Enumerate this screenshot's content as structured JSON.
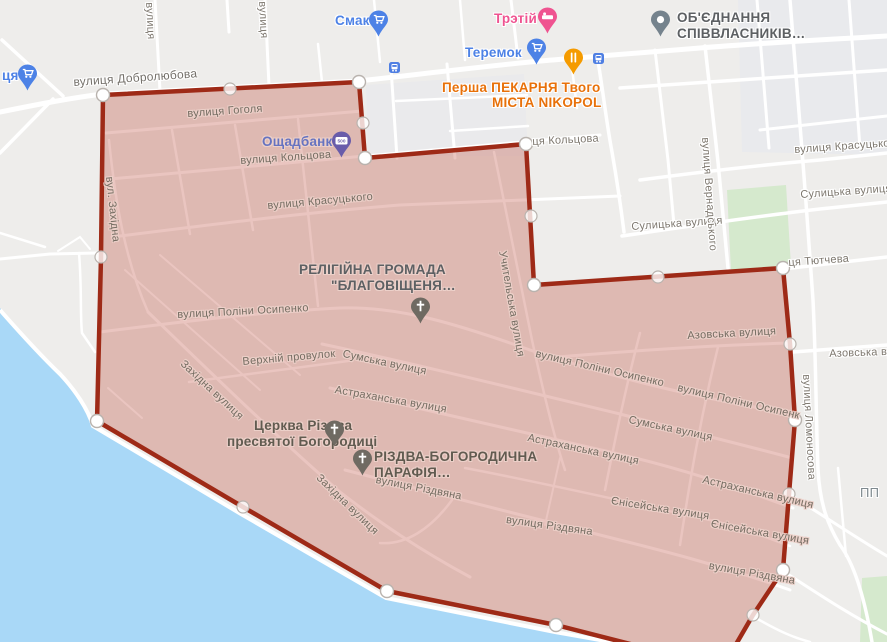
{
  "map_meta": {
    "description": "Map of Nikopol, Ukraine with red polygon area selection",
    "colors": {
      "land": "#eeedeb",
      "blocks_cool": "#e9eaed",
      "road": "#ffffff",
      "water": "#a9d8f7",
      "park": "#d5e9cd",
      "polygon_fill": "#be4b3c",
      "polygon_fill_opacity": "0.32",
      "polygon_stroke": "#9e2a17",
      "vertex_fill": "#ffffff",
      "poi_blue": "#4d82e6",
      "poi_pink": "#ef5390",
      "poi_orange": "#e8710a",
      "poi_violet": "#6673c0",
      "bank_pin": "#695caa",
      "gray_pin": "#75838d",
      "church_pin": "#6f6a62",
      "street_label": "#7d776e"
    }
  },
  "streets": {
    "dobrolyubova": "вулиця Добролюбова",
    "vulytsya": "вулиця",
    "gogolya": "вулиця Гоголя",
    "koltsova": "вулиця Кольцова",
    "tsya_koltsova": "ця Кольцова",
    "krasutskogo": "вулиця Красуцького",
    "zahidna_short": "вул. Західна",
    "polina_osypenko": "вулиця Поліни Осипенко",
    "polina_osypenko_cut": "вулиця Поліни Осипенк",
    "uchytelska": "Учительська вулиця",
    "verkhniy_provulok": "Верхній провулок",
    "sumska": "Сумська вулиця",
    "astrakhanska": "Астраханська вулиця",
    "zahidna": "Західна вулиця",
    "rizdvyana": "вулиця Різдвяна",
    "yeniseyska": "Єнісейська вулиця",
    "azovska": "Азовська вулиця",
    "azovska_cut": "Азовська вул",
    "sulytska": "Сулицька вулиця",
    "vernadskogo": "вулиця Вернадського",
    "lomonosova": "вулиця Ломоносова",
    "tyutcheva": "ця Тютчева",
    "pp": "ПП"
  },
  "pois": {
    "tsya": "ця",
    "smak": "Смак",
    "teremok": "Теремок",
    "tretiy": "Трэтій",
    "persha_line1": "Перша ПЕКАРНЯ Твого",
    "persha_line2": "МІСТА NIKOPOL",
    "obyednannya_line1": "ОБ'ЄДНАННЯ",
    "obyednannya_line2": "СПІВВЛАСНИКІВ…",
    "oschadbank": "Ощадбанк",
    "oschadbank_pin_text": "500",
    "religiyna_line1": "РЕЛІГІЙНА ГРОМАДА",
    "religiyna_line2": "\"БЛАГОВІЩЕНЯ…",
    "tserkva_line1": "Церква Різдва",
    "tserkva_line2": "пресвятої Богородиці",
    "rizdva_line1": "РІЗДВА-БОГОРОДИЧНА",
    "rizdva_line2": "ПАРАФІЯ…"
  }
}
